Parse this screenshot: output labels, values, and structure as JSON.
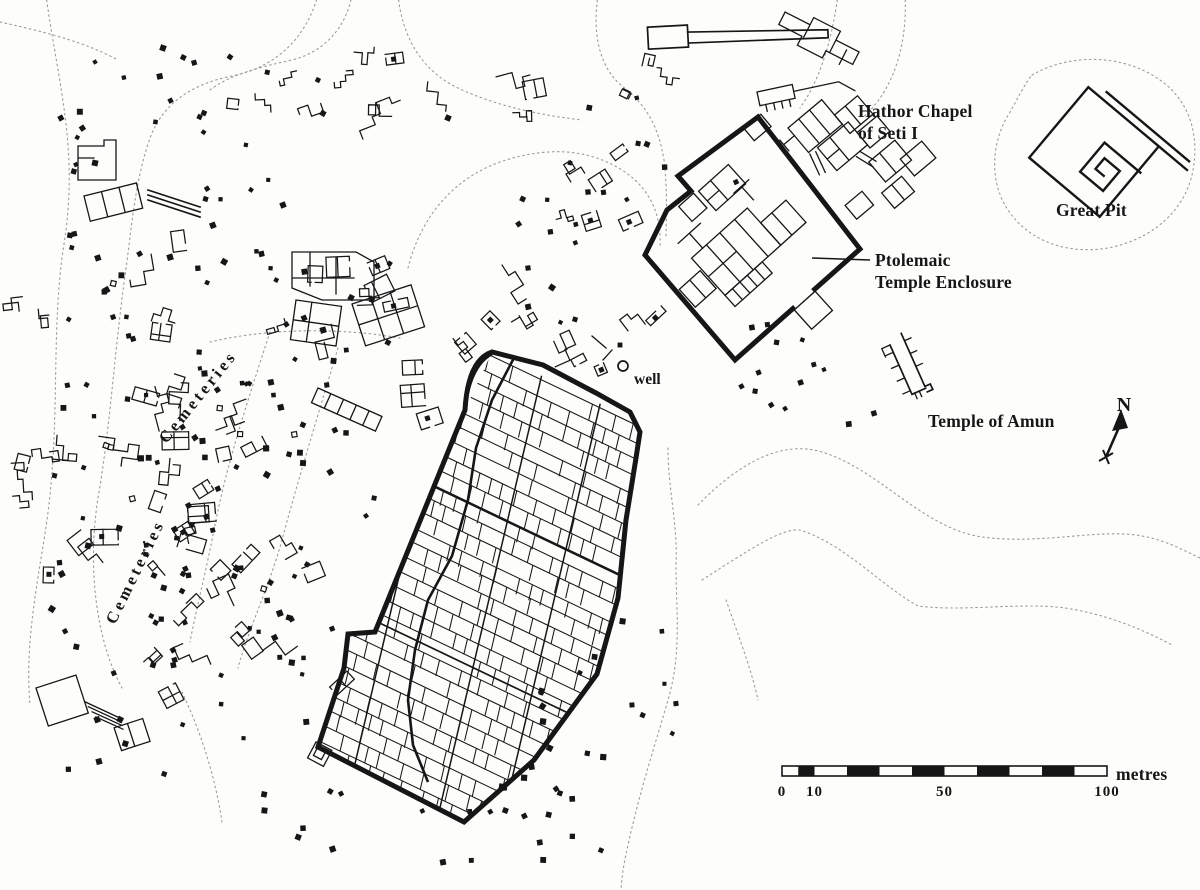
{
  "colors": {
    "background": "#fdfdfb",
    "ink": "#161616",
    "contour": "#9a9a9a"
  },
  "labels": {
    "hathor_chapel_line1": "Hathor Chapel",
    "hathor_chapel_line2": "of Seti I",
    "great_pit": "Great Pit",
    "ptolemaic_line1": "Ptolemaic",
    "ptolemaic_line2": "Temple Enclosure",
    "temple_of_amun": "Temple of Amun",
    "well": "well",
    "cemeteries_upper": "Cemeteries",
    "cemeteries_lower": "Cemeteries",
    "north_indicator": "N"
  },
  "scale_bar": {
    "unit_label": "metres",
    "length_m": 100,
    "tick_labels": [
      "0",
      "10",
      "50",
      "100"
    ],
    "tick_positions_m": [
      0,
      10,
      50,
      100
    ],
    "segments_m": [
      [
        0,
        5,
        "light"
      ],
      [
        5,
        10,
        "dark"
      ],
      [
        10,
        20,
        "light"
      ],
      [
        20,
        30,
        "dark"
      ],
      [
        30,
        40,
        "light"
      ],
      [
        40,
        50,
        "dark"
      ],
      [
        50,
        60,
        "light"
      ],
      [
        60,
        70,
        "dark"
      ],
      [
        70,
        80,
        "light"
      ],
      [
        80,
        90,
        "dark"
      ],
      [
        90,
        100,
        "light"
      ]
    ]
  }
}
